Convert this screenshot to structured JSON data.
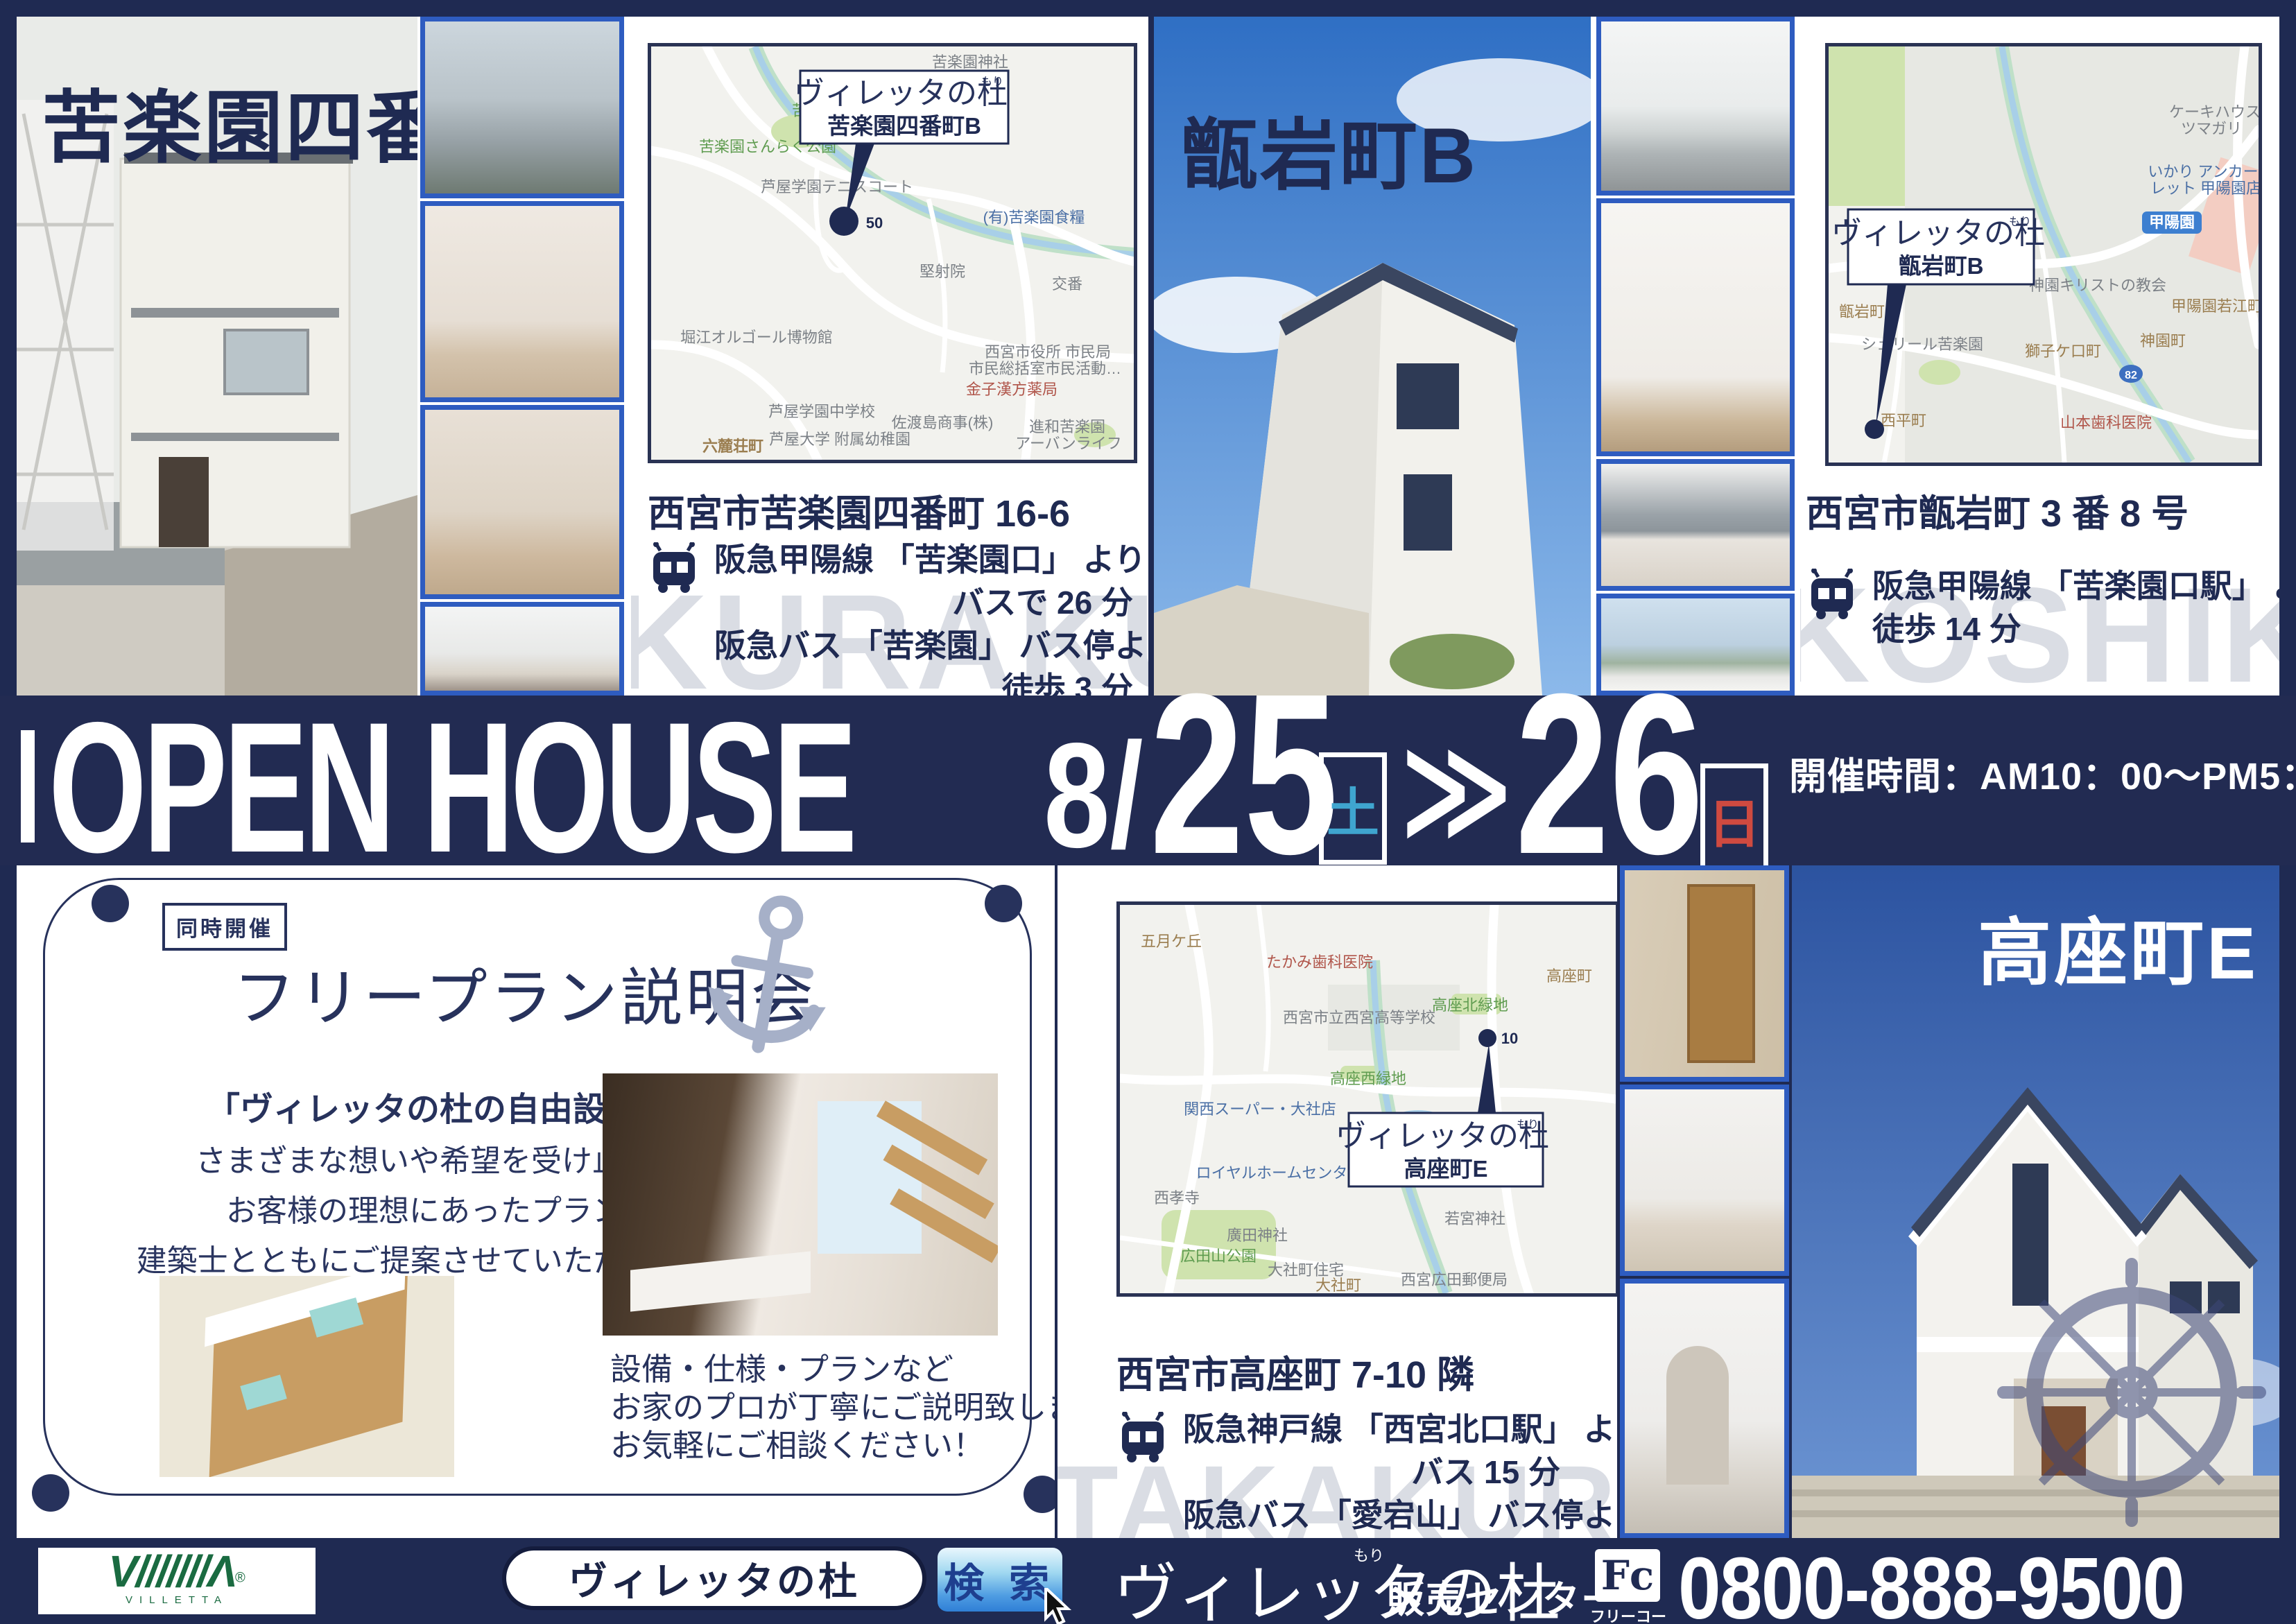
{
  "brand": {
    "name": "ヴィレッタの杜",
    "furigana": "もり"
  },
  "colors": {
    "navy": "#1f2a52",
    "photo_frame_blue": "#2e5cc0",
    "saturday_teal": "#3fa5cf",
    "sunday_red": "#cf4a40",
    "logo_green": "#1a6b41",
    "watermark_gray": "#dadde4",
    "search_button_blue": "#2f7fd6",
    "anchor_gray": "#a6b0c8"
  },
  "kurakuen": {
    "title": "苦楽園四番町B",
    "address": "西宮市苦楽園四番町 16-6",
    "access": [
      "阪急甲陽線 「苦楽園口」 より",
      "バスで 26 分",
      "阪急バス 「苦楽園」 バス停より",
      "徒歩 3 分"
    ],
    "watermark": "KURAKUEN",
    "map": {
      "callout_name": "苦楽園四番町B",
      "marker": "50",
      "labels": [
        "苦楽園神社",
        "苦楽園しろ",
        "苦楽園さんらく公園",
        "芦屋学園テニスコート",
        "(有)苦楽園食糧",
        "交番",
        "堅射院",
        "堀江オルゴール博物館",
        "西宮市役所 市民局",
        "市民総括室市民活動…",
        "金子漢方薬局",
        "芦屋学園中学校",
        "佐渡島商事(株)",
        "芦屋大学 附属幼稚園",
        "六麓荘町",
        "進和苦楽園",
        "アーバンライフ"
      ]
    }
  },
  "koshikiiwa": {
    "title": "甑岩町B",
    "address": "西宮市甑岩町 3 番 8 号",
    "access": [
      "阪急甲陽線 「苦楽園口駅」 より",
      "徒歩 14 分"
    ],
    "watermark": "KOSHIKIIWA",
    "map": {
      "callout_name": "甑岩町B",
      "labels": [
        "ケーキハウス",
        "ツマガリ",
        "いかり アンカー",
        "レット 甲陽園店",
        "甲陽園",
        "神園キリストの教会",
        "甲陽園若江町",
        "甑岩町",
        "シェリール苦楽園",
        "獅子ケ口町",
        "神園町",
        "西平町",
        "山本歯科医院",
        "82"
      ]
    }
  },
  "takakura": {
    "title": "高座町E",
    "address": "西宮市高座町 7-10 隣",
    "access": [
      "阪急神戸線 「西宮北口駅」 より",
      "バス 15 分",
      "阪急バス 「愛宕山」 バス停より",
      "徒歩 3 分"
    ],
    "watermark": "TAKAKURACYO",
    "map": {
      "callout_name": "高座町E",
      "marker": "10",
      "labels": [
        "五月ケ丘",
        "たかみ歯科医院",
        "西宮市立西宮高等学校",
        "高座北緑地",
        "高座町",
        "高座西緑地",
        "関西スーパー・大社店",
        "ロイヤルホームセンター西宮",
        "西孝寺",
        "廣田神社",
        "広田山公園",
        "大社町住宅",
        "大社町",
        "若宮神社",
        "西宮広田郵便局"
      ]
    }
  },
  "banner": {
    "title": "OPEN HOUSE",
    "month": "8/",
    "day1": "25",
    "day1_dow": "土",
    "arrow": "≫",
    "day2": "26",
    "day2_dow": "日",
    "time": "開催時間：AM10：00～PM5：00"
  },
  "seminar": {
    "badge": "同時開催",
    "title": "フリープラン説明会",
    "quote": "「ヴィレッタの杜の自由設計」",
    "body": [
      "さまざまな想いや希望を受け止め、",
      "お客様の理想にあったプランを",
      "建築士とともにご提案させていただきます。"
    ],
    "notes": [
      "設備・仕様・プランなど",
      "お家のプロが丁寧にご説明致します！",
      "お気軽にご相談ください！"
    ]
  },
  "footer": {
    "logo_mark": "V///////Λ",
    "logo_reg": "®",
    "logo_text": "VILLETTA",
    "search_value": "ヴィレッタの杜",
    "search_button": "検 索",
    "center_suffix": "販売センター",
    "freecall_mark": "Fc",
    "freecall_label": "フリーコール",
    "phone": "0800-888-9500"
  }
}
